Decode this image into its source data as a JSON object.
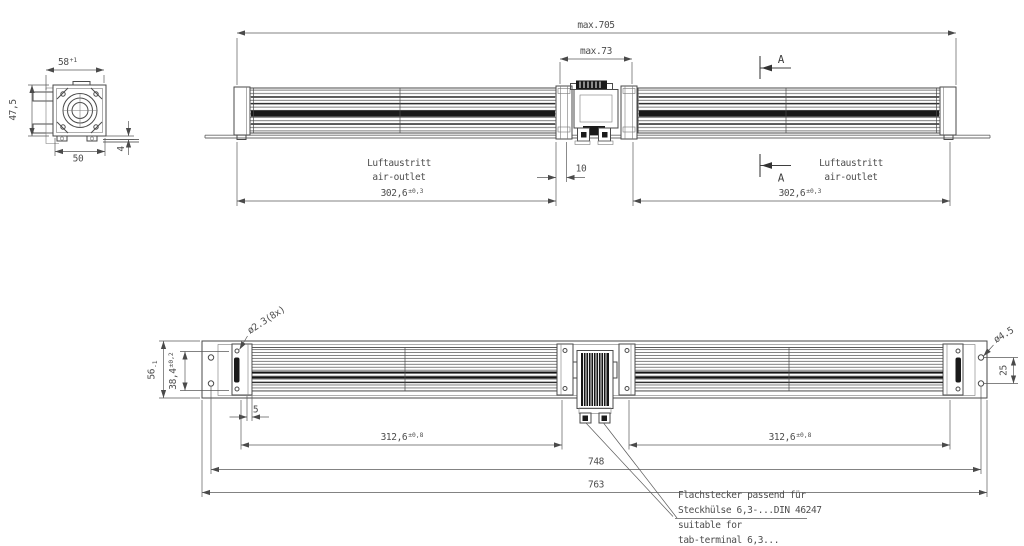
{
  "drawing": {
    "colors": {
      "line": "#4a4a4a",
      "text": "#4d4d4d",
      "dark_fill": "#1a1a1a",
      "background": "#ffffff"
    },
    "end_view": {
      "width_top": "58",
      "width_top_tol": "+1",
      "height": "47,5",
      "depth": "50",
      "plate_offset": "4"
    },
    "side_view": {
      "overall_length": "max.705",
      "motor_width": "max.73",
      "motor_gap": "10",
      "outlet_left": "302,6",
      "outlet_left_tol": "±0,3",
      "outlet_right": "302,6",
      "outlet_right_tol": "±0,3",
      "luftaustritt_left": "Luftaustritt",
      "air_outlet_left": "air-outlet",
      "luftaustritt_right": "Luftaustritt",
      "air_outlet_right": "air-outlet",
      "section_a_top": "A",
      "section_a_bottom": "A"
    },
    "bottom_view": {
      "plate_height": "56",
      "plate_height_tol": "-1",
      "outlet_width": "38,4",
      "outlet_width_tol": "±0,2",
      "end_offset": "5",
      "rotor_left": "312,6",
      "rotor_left_tol": "±0,8",
      "rotor_right": "312,6",
      "rotor_right_tol": "±0,8",
      "hole_span": "748",
      "overall_width": "763",
      "hole_pitch": "25",
      "screw_callout": "ø2.3(8x)",
      "hole_callout": "ø4.5",
      "note_de_1": "Flachstecker passend für",
      "note_de_2": "Steckhülse 6,3-...DIN 46247",
      "note_en_1": "suitable for",
      "note_en_2": "tab-terminal 6,3..."
    }
  }
}
